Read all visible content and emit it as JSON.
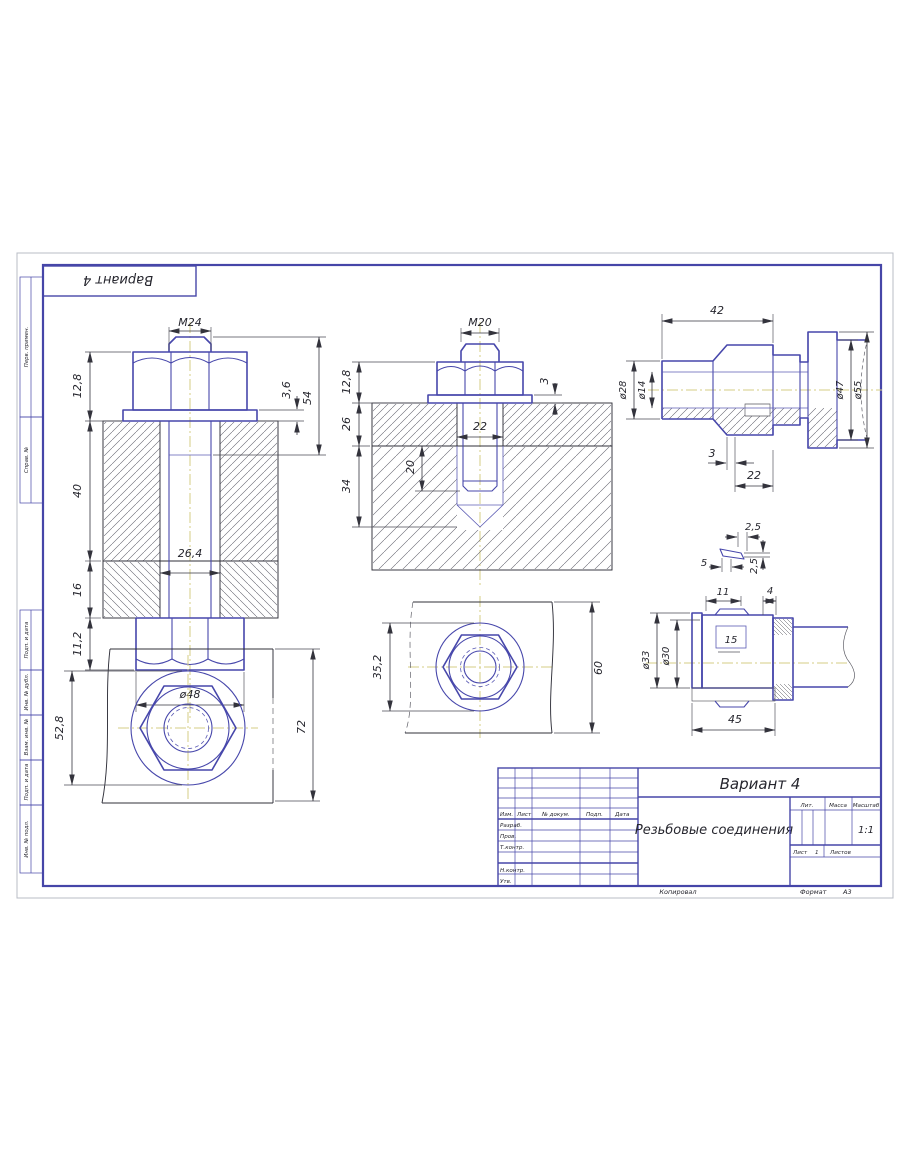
{
  "page": {
    "corner_stamp": "Вариант 4",
    "margin": [
      "Перв. примен.",
      "Справ. №",
      "Подп. и дата",
      "Инв. № дубл.",
      "Взам. инв. №",
      "Подп. и дата",
      "Инв. № подл."
    ]
  },
  "views": {
    "v1": {
      "thread": "M24",
      "s1": "12,8",
      "s2": "40",
      "s3": "16",
      "s4": "11,2",
      "hole": "26,4",
      "across": "ø48",
      "washer": "3,6",
      "len": "54"
    },
    "v2": {
      "thread": "M20",
      "s1": "12,8",
      "s2": "26",
      "s3": "34",
      "depth": "20",
      "hole": "22",
      "washer": "3"
    },
    "v3": {
      "len": "42",
      "d1": "ø28",
      "d2": "ø14",
      "d3": "ø47",
      "d4": "ø55",
      "gap": "3",
      "nut": "22"
    },
    "v4": {
      "washer": "52,8",
      "plate": "72"
    },
    "v5": {
      "washer": "35,2",
      "plate": "60"
    },
    "v6": {
      "a": "2,5",
      "b": "5",
      "c": "2,5",
      "l1": "11",
      "l2": "4",
      "win": "15",
      "d1": "ø33",
      "d2": "ø30",
      "len": "45"
    }
  },
  "title_block": {
    "variant": "Вариант 4",
    "doc_title": "Резьбовые соединения",
    "cols": {
      "izm": "Изм.",
      "list": "Лист",
      "doc": "№ докум.",
      "podp": "Подп.",
      "data": "Дата"
    },
    "rows": {
      "razrab": "Разраб.",
      "prov": "Пров.",
      "tkontr": "Т.контр.",
      "nkontr": "Н.контр.",
      "utv": "Утв."
    },
    "lit": "Лит.",
    "massa": "Масса",
    "masshtab": "Масштаб",
    "scale": "1:1",
    "list_label": "Лист",
    "list_value": "1",
    "listov_label": "Листов",
    "kopiroval": "Копировал",
    "format_label": "Формат",
    "format_value": "А3"
  }
}
